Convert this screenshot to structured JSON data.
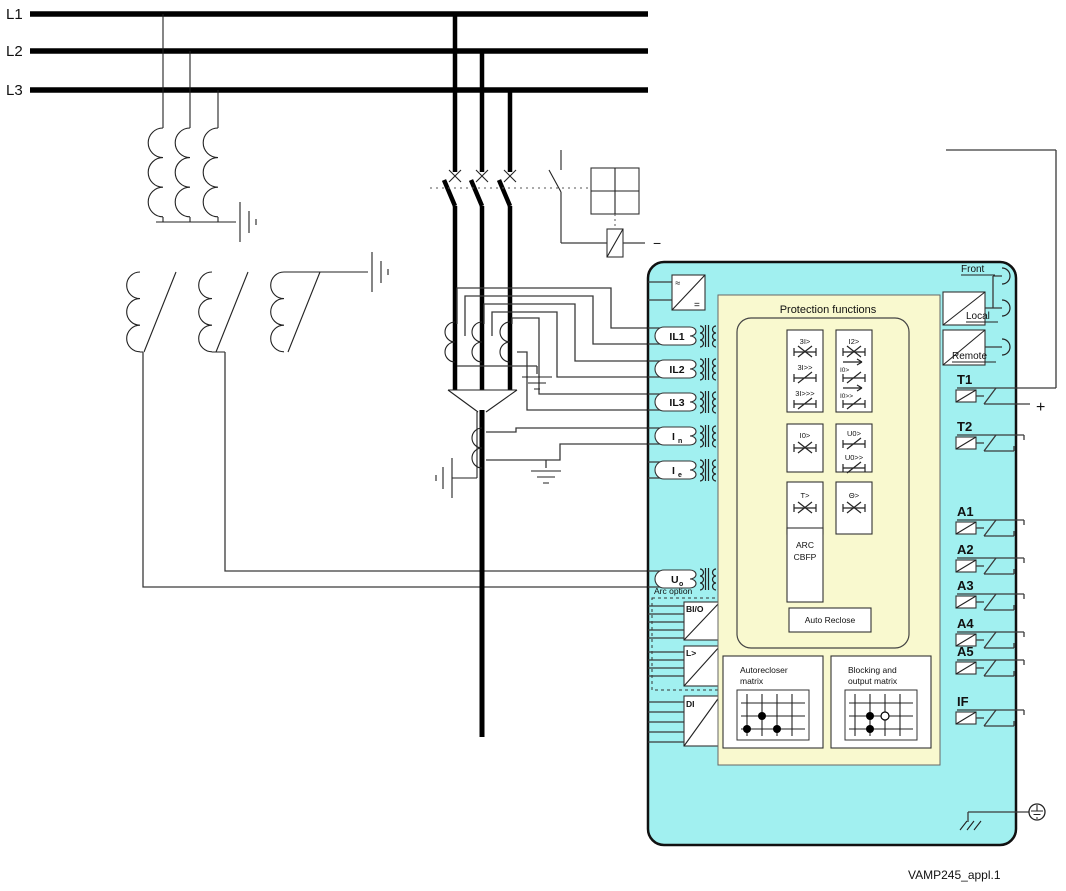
{
  "buses": {
    "l1": "L1",
    "l2": "L2",
    "l3": "L3"
  },
  "breaker": {
    "minus": "−",
    "plus": "+"
  },
  "relay": {
    "power_ac": "≈",
    "power_dc": "=",
    "inputs": [
      {
        "label": "IL1",
        "sub": ""
      },
      {
        "label": "IL2",
        "sub": ""
      },
      {
        "label": "IL3",
        "sub": ""
      },
      {
        "label": "I",
        "sub": "n"
      },
      {
        "label": "I",
        "sub": "e"
      },
      {
        "label": "U",
        "sub": "o"
      }
    ],
    "arc_option": {
      "title": "Arc option",
      "box1": "BI/O",
      "box2": "L>",
      "di": "DI"
    },
    "protection": {
      "title": "Protection functions",
      "groups": [
        [
          "3I>",
          "3I>>",
          "3I>>>"
        ],
        [
          "I2>",
          "I0>",
          "I0>>"
        ],
        [
          "I0>"
        ],
        [
          "U0>",
          "U0>>"
        ],
        [
          "T>"
        ],
        [
          "Θ>"
        ],
        [
          "ARC",
          "CBFP"
        ],
        [
          "Auto Reclose"
        ]
      ]
    },
    "matrices": [
      {
        "line1": "Autorecloser",
        "line2": "matrix"
      },
      {
        "line1": "Blocking and",
        "line2": "output matrix"
      }
    ],
    "comm": {
      "front": "Front",
      "local": "Local",
      "remote": "Remote"
    },
    "outputs": [
      "T1",
      "T2",
      "A1",
      "A2",
      "A3",
      "A4",
      "A5",
      "IF"
    ]
  },
  "caption": "VAMP245_appl.1",
  "colors": {
    "relay": "#a1f0f0",
    "panel": "#f9f9cf"
  }
}
